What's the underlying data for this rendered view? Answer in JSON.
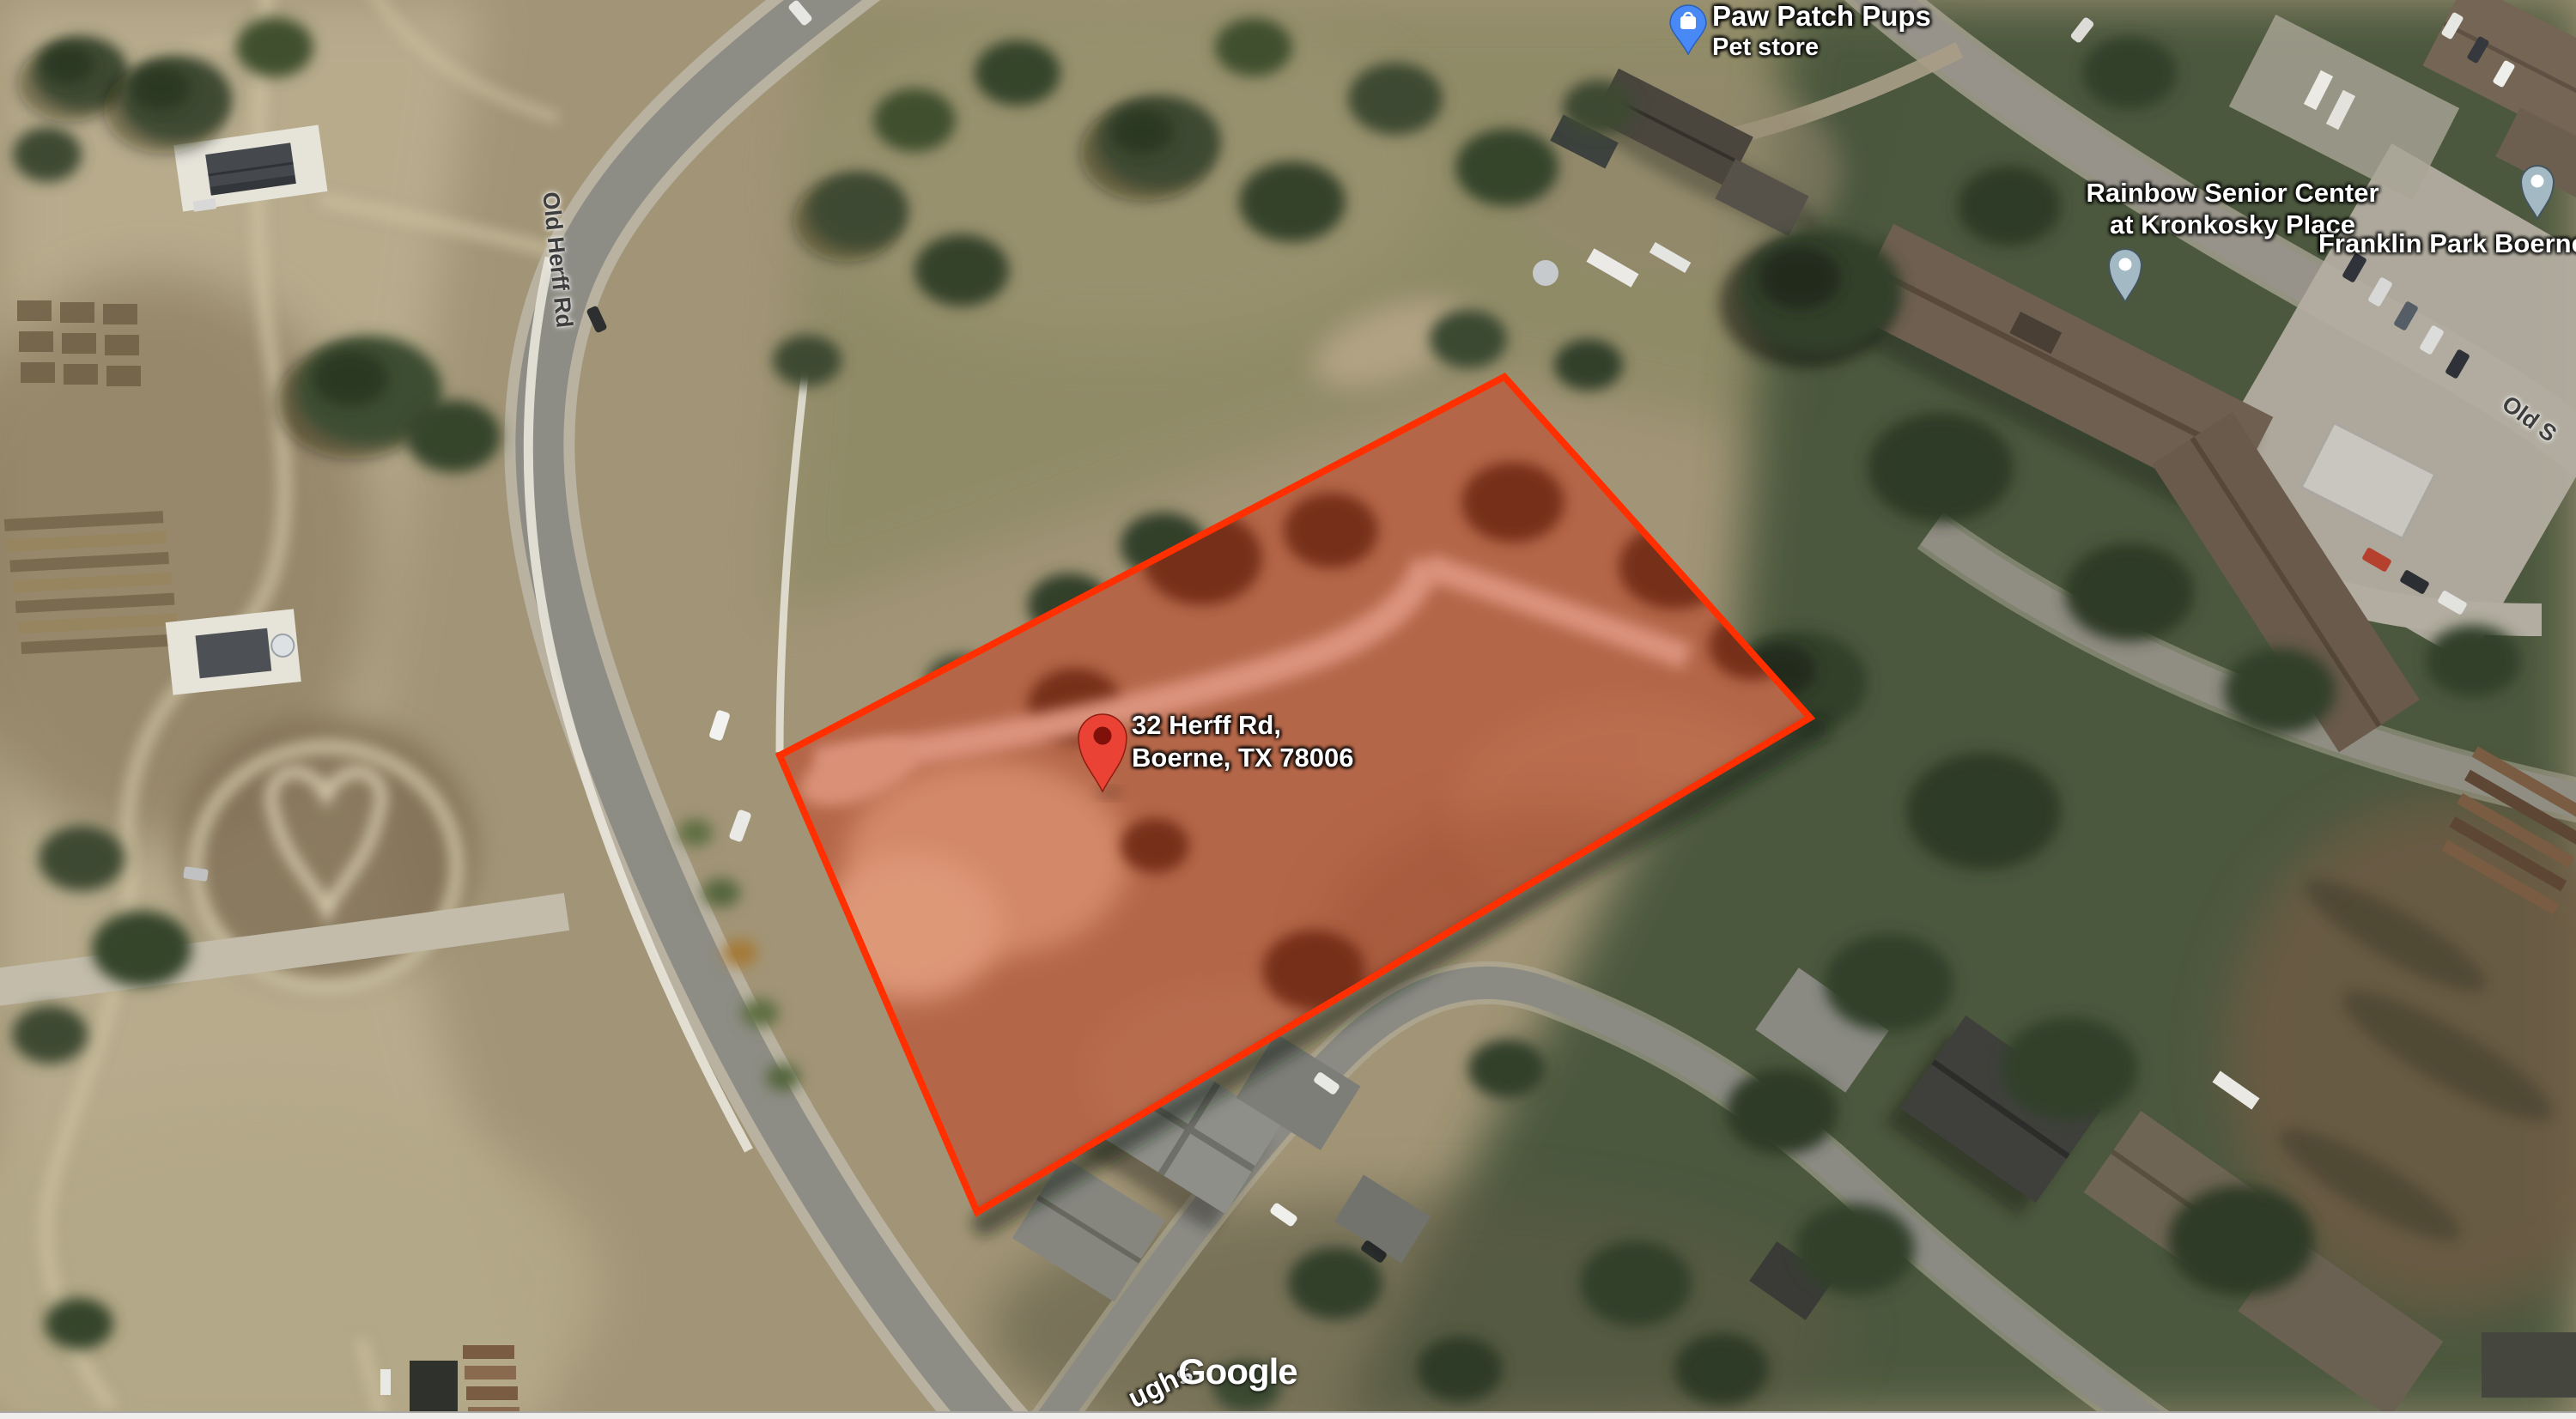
{
  "watermark": {
    "logo": "Google"
  },
  "marker": {
    "title_line1": "32 Herff Rd,",
    "title_line2": "Boerne, TX 78006"
  },
  "pois": [
    {
      "id": "paw-patch",
      "name": "Paw Patch Pups",
      "category": "Pet store"
    },
    {
      "id": "rainbow",
      "name_line1": "Rainbow Senior Center",
      "name_line2": "at Kronkosky Place"
    },
    {
      "id": "franklin",
      "name": "Franklin Park Boerne"
    }
  ],
  "road_labels": [
    {
      "id": "old-herff",
      "text": "Old Herff Rd"
    },
    {
      "id": "old-san-antonio",
      "text": "Old S"
    },
    {
      "id": "hughs",
      "text": "ughs"
    }
  ],
  "colors": {
    "parcel_stroke": "#ff2f00",
    "parcel_fill": "rgba(255,45,0,0.25)",
    "pin_red": "#EA4335",
    "pin_red_dot": "#7F100A",
    "pin_blue": "#4989F5",
    "pin_gray": "#A3B9C4",
    "pin_gray_rim": "#45555E",
    "pin_white": "#FFFFFF"
  }
}
